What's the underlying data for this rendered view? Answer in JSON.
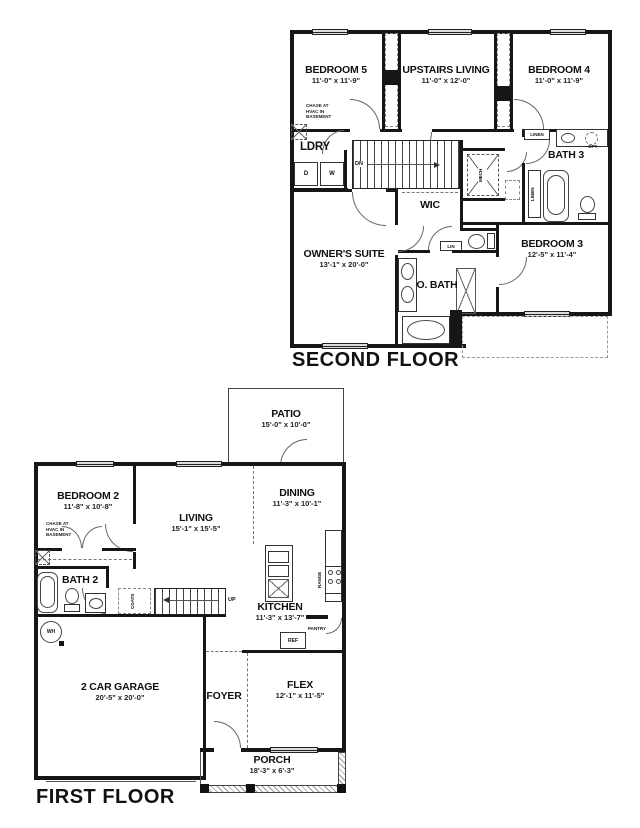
{
  "second_floor": {
    "title": "SECOND FLOOR",
    "bedroom5_name": "BEDROOM 5",
    "bedroom5_dims": "11'-0\" x 11'-9\"",
    "upstairs_living_name": "UPSTAIRS LIVING",
    "upstairs_living_dims": "11'-0\" x 12'-0\"",
    "bedroom4_name": "BEDROOM 4",
    "bedroom4_dims": "11'-0\" x 11'-9\"",
    "owners_suite_name": "OWNER'S SUITE",
    "owners_suite_dims": "13'-1\" x 20'-0\"",
    "bedroom3_name": "BEDROOM 3",
    "bedroom3_dims": "12'-5\" x 11'-4\"",
    "ldry": "LDRY",
    "bath3": "BATH 3",
    "wic": "WIC",
    "obath": "O. BATH",
    "dn": "DN",
    "mech": "MECH",
    "lin": "LIN",
    "linen_top": "LINEN",
    "linen_side": "LINEN",
    "opt": "OPT",
    "dryer": "D",
    "washer": "W",
    "chase_note": "CHASE AT\nHVAC IN\nBASEMENT"
  },
  "first_floor": {
    "title": "FIRST FLOOR",
    "patio_name": "PATIO",
    "patio_dims": "15'-0\" x 10'-0\"",
    "bedroom2_name": "BEDROOM 2",
    "bedroom2_dims": "11'-8\" x 10'-8\"",
    "living_name": "LIVING",
    "living_dims": "15'-1\" x 15'-5\"",
    "dining_name": "DINING",
    "dining_dims": "11'-3\" x 10'-1\"",
    "kitchen_name": "KITCHEN",
    "kitchen_dims": "11'-3\" x 13'-7\"",
    "garage_name": "2 CAR GARAGE",
    "garage_dims": "20'-5\" x 20'-0\"",
    "flex_name": "FLEX",
    "flex_dims": "12'-1\" x 11'-5\"",
    "porch_name": "PORCH",
    "porch_dims": "18'-3\" x 6'-3\"",
    "foyer": "FOYER",
    "bath2": "BATH 2",
    "up": "UP",
    "coats": "COATS",
    "wh": "WH",
    "range": "RANGE",
    "ref": "REF",
    "pantry": "PANTRY",
    "chase_note": "CHASE AT\nHVAC IN\nBASEMENT"
  }
}
